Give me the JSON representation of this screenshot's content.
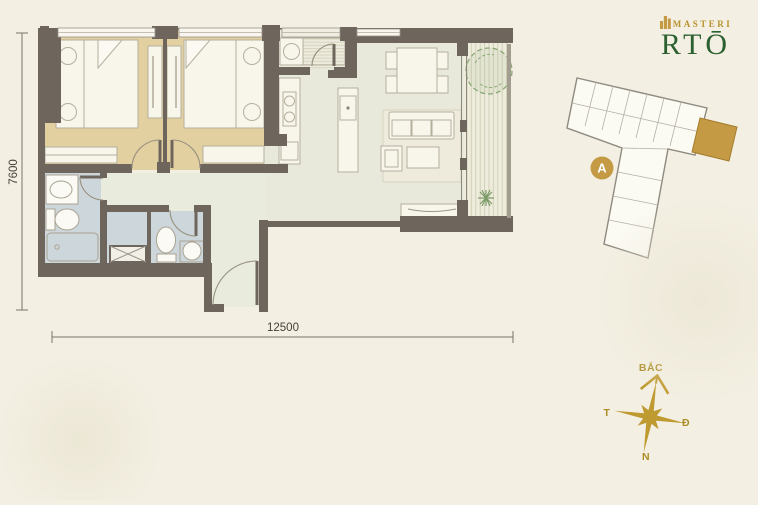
{
  "logo": {
    "brand": "MASTERI",
    "name": "RTŌ"
  },
  "plan": {
    "width_dim": "12500",
    "height_dim": "7600",
    "rooms": [
      "bedroom-1",
      "bedroom-2",
      "bathroom-1",
      "bathroom-2",
      "utility",
      "kitchen",
      "living-dining",
      "hallway",
      "entry",
      "balcony",
      "shaft"
    ]
  },
  "keyplan": {
    "badge": "A"
  },
  "compass": {
    "north": "BẮC",
    "west": "T",
    "east": "Đ",
    "south": "N"
  },
  "icons": {
    "logo_mark": "building-icon",
    "keyplan_marker": "block-a-badge",
    "compass_rose": "eight-point-star-icon",
    "balcony_tree": "tree-icon",
    "balcony_plant": "plant-icon"
  },
  "colors": {
    "background": "#f3efe2",
    "wall": "#6e665d",
    "bedroom_floor": "#e3d0a0",
    "living_floor": "#e8e9da",
    "bath_floor": "#cdd6da",
    "deck": "#edecdd",
    "gold_accent": "#c59a44",
    "logo_green": "#2b6130",
    "compass_gold": "#bf9a31"
  }
}
